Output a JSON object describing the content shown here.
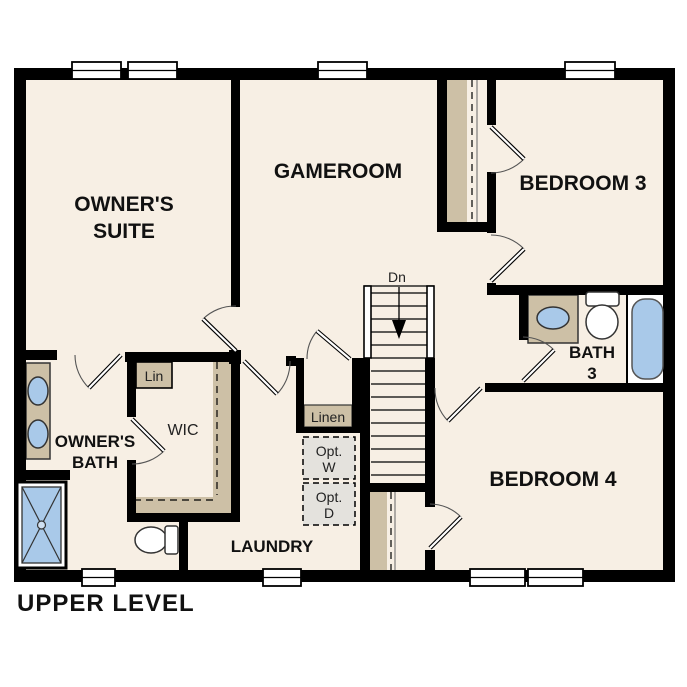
{
  "plan_title": "UPPER LEVEL",
  "rooms": {
    "owners_suite": {
      "line1": "OWNER'S",
      "line2": "SUITE"
    },
    "gameroom": {
      "label": "GAMEROOM"
    },
    "bedroom3": {
      "label": "BEDROOM 3"
    },
    "bedroom4": {
      "label": "BEDROOM 4"
    },
    "owners_bath": {
      "line1": "OWNER'S",
      "line2": "BATH"
    },
    "bath3": {
      "line1": "BATH",
      "line2": "3"
    },
    "wic": {
      "label": "WIC"
    },
    "laundry": {
      "label": "LAUNDRY"
    }
  },
  "closets": {
    "lin_label": "Lin",
    "linen_label": "Linen"
  },
  "optional_appliances": {
    "washer_line1": "Opt.",
    "washer_line2": "W",
    "dryer_line1": "Opt.",
    "dryer_line2": "D"
  },
  "stairs": {
    "down_label": "Dn"
  },
  "colors": {
    "wall": "#000000",
    "floor": "#F7EFE4",
    "casework": "#CDC0A6",
    "fixture_blue": "#A9C9E9",
    "optional_gray": "#E4E2DD",
    "background": "#FFFFFF"
  }
}
